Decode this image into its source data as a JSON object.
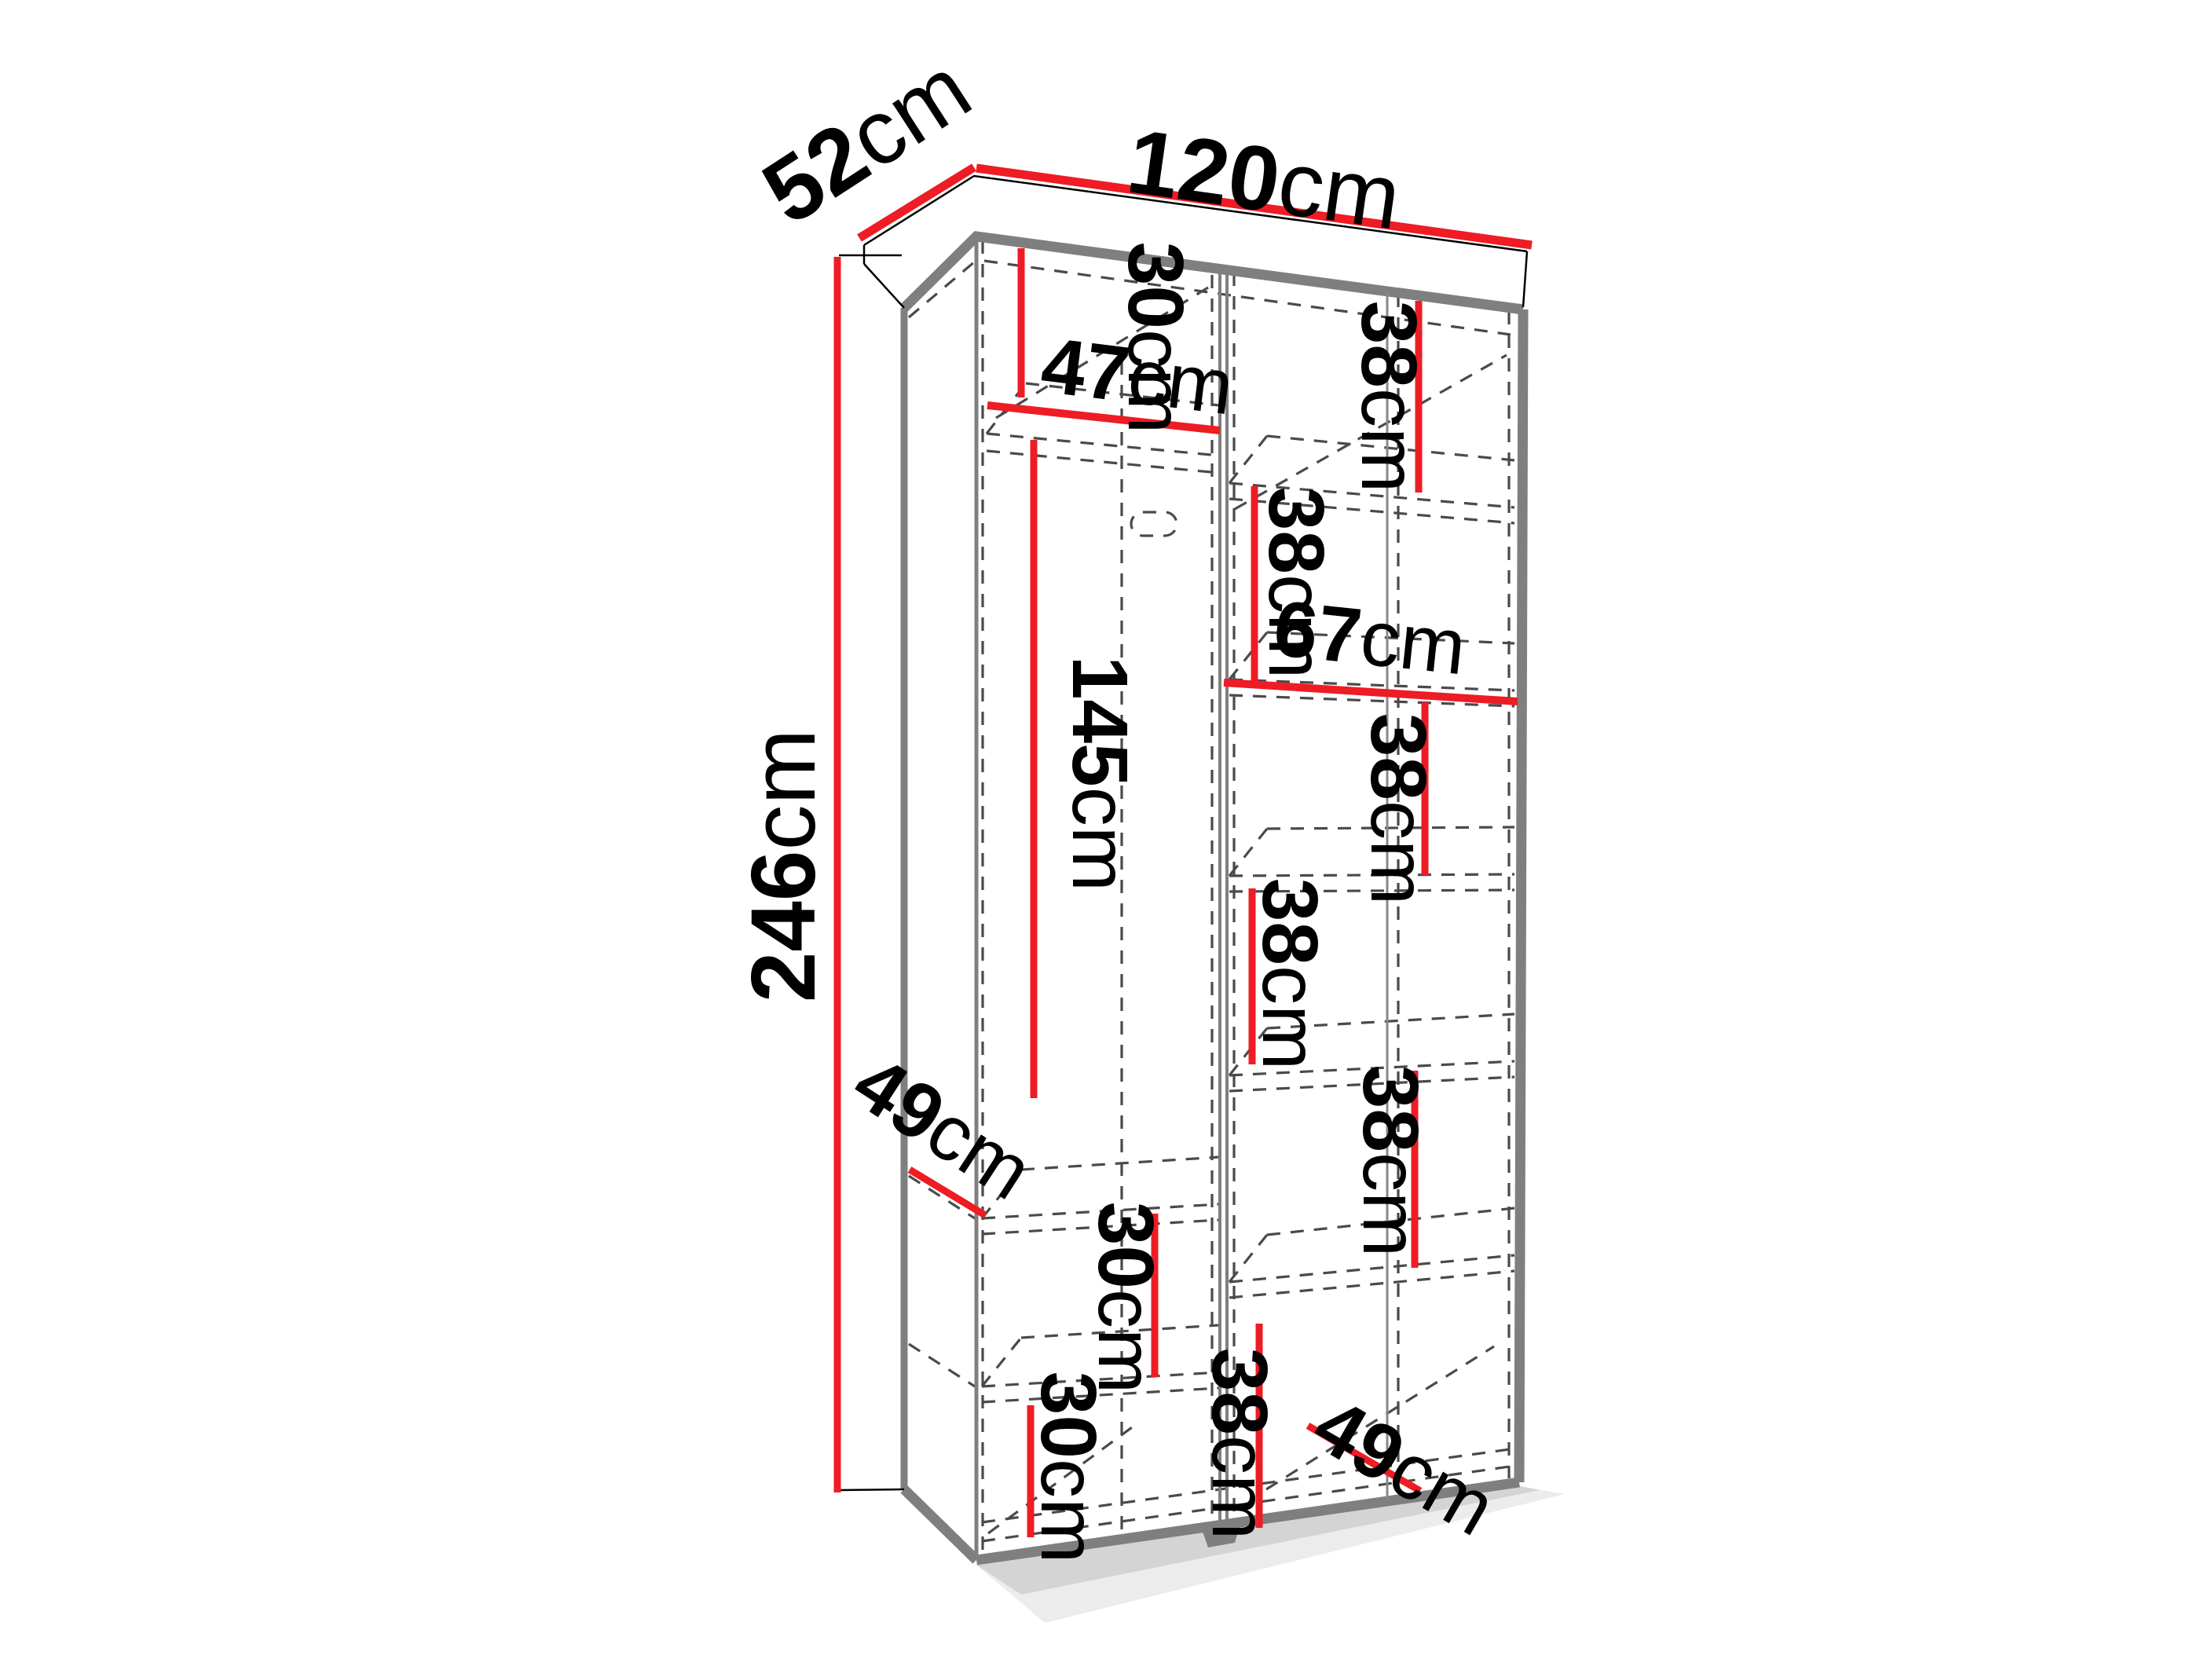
{
  "diagram": {
    "kind": "wardrobe-dimension-diagram",
    "colors": {
      "dimension_line": "#ee1c25",
      "visible_edge": "#7f7f7f",
      "hidden_edge": "#4a4a4a",
      "outline": "#000000",
      "background": "#ffffff",
      "text": "#000000"
    },
    "dims": {
      "depth": {
        "v": "52",
        "u": "cm"
      },
      "width": {
        "v": "120",
        "u": "cm"
      },
      "height": {
        "v": "246",
        "u": "cm"
      },
      "top_shelf_h": {
        "v": "30",
        "u": "cm"
      },
      "top_shelf_w": {
        "v": "47",
        "u": "cm"
      },
      "hanging_h": {
        "v": "145",
        "u": "cm"
      },
      "side_depth": {
        "v": "49",
        "u": "cm"
      },
      "low_shelf_a": {
        "v": "30",
        "u": "cm"
      },
      "low_shelf_b": {
        "v": "30",
        "u": "cm"
      },
      "right_s1": {
        "v": "38",
        "u": "cm"
      },
      "right_s2": {
        "v": "38",
        "u": "cm"
      },
      "right_width": {
        "v": "67",
        "u": "cm"
      },
      "right_s3": {
        "v": "38",
        "u": "cm"
      },
      "right_s4": {
        "v": "38",
        "u": "cm"
      },
      "right_s5": {
        "v": "38",
        "u": "cm"
      },
      "right_s6": {
        "v": "38",
        "u": "cm"
      },
      "right_depth": {
        "v": "49",
        "u": "cm"
      }
    }
  }
}
